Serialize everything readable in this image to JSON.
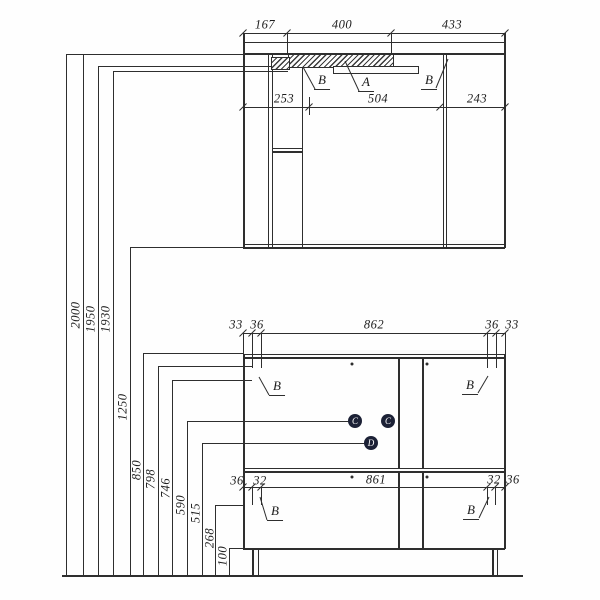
{
  "top_cabinet": {
    "width_dims": [
      "167",
      "400",
      "433"
    ],
    "section_dims": [
      "253",
      "504",
      "243"
    ],
    "callouts": [
      "B",
      "A",
      "B"
    ]
  },
  "bottom_cabinet": {
    "top_width_dims": [
      "33",
      "36",
      "862",
      "36",
      "33"
    ],
    "door_callouts": [
      "B",
      "B"
    ],
    "knob_callouts": [
      "C",
      "C",
      "D"
    ],
    "drawer_width_dims": [
      "36",
      "32",
      "861",
      "32",
      "36"
    ],
    "drawer_callouts": [
      "B",
      "B"
    ]
  },
  "height_dims": [
    "2000",
    "1950",
    "1930",
    "1250",
    "850",
    "798",
    "746",
    "590",
    "515",
    "268",
    "100"
  ],
  "colors": {
    "line": "#2e2e2e",
    "balloon_fill": "#1c2136",
    "balloon_text": "#ffffff",
    "background": "#fefefe"
  }
}
